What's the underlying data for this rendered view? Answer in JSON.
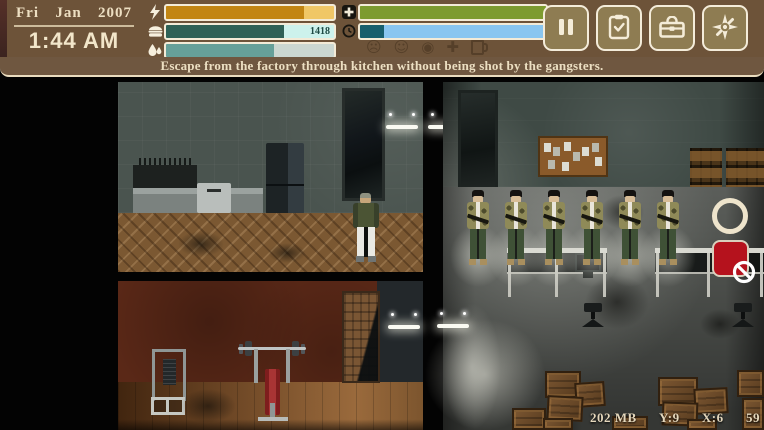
{
  "hud": {
    "date": {
      "weekday": "Fri",
      "month": "Jan",
      "year": "2007",
      "time": "1:44 AM"
    },
    "stats": {
      "energy": {
        "icon": "lightning-icon",
        "percent": 82,
        "fill_color": "#c28512",
        "track_color": "#f0c766"
      },
      "hunger": {
        "icon": "burger-icon",
        "percent": 70,
        "value_label": "1418",
        "fill_color": "#2e6156",
        "track_color": "#cdf2ec"
      },
      "thirst": {
        "icon": "drops-icon",
        "percent": 64,
        "fill_color": "#66a099",
        "track_color": "#cbd7d1"
      },
      "health": {
        "icon": "plus-icon",
        "percent": 100,
        "fill_color": "#7d9b2f",
        "track_color": "#7d9b2f"
      },
      "sleep": {
        "icon": "clock-icon",
        "percent": 13,
        "fill_color": "#175f6d",
        "track_color": "#89c6f0"
      }
    },
    "effect_icons": [
      {
        "name": "dizzy-face-icon",
        "glyph": "☹"
      },
      {
        "name": "smiley-face-icon",
        "glyph": "☺"
      },
      {
        "name": "eye-icon",
        "glyph": "◉"
      },
      {
        "name": "cross-icon",
        "glyph": "✚"
      },
      {
        "name": "mug-icon",
        "glyph": ""
      }
    ],
    "buttons": [
      {
        "name": "pause-button"
      },
      {
        "name": "journal-button"
      },
      {
        "name": "inventory-button"
      },
      {
        "name": "compass-button"
      }
    ]
  },
  "objective": {
    "text": "Escape from the factory through kitchen without being shot by the gangsters."
  },
  "status_bar": {
    "memory": "202 MB",
    "coord_y": "Y:9",
    "coord_x": "X:6",
    "fps": "59"
  },
  "colors": {
    "hud_bg": "#6d5339",
    "objective_bg": "#6f5740",
    "button_bg": "#8e7c52",
    "forbidden_red": "#b5121d",
    "ring_cream": "#eee4cc"
  }
}
